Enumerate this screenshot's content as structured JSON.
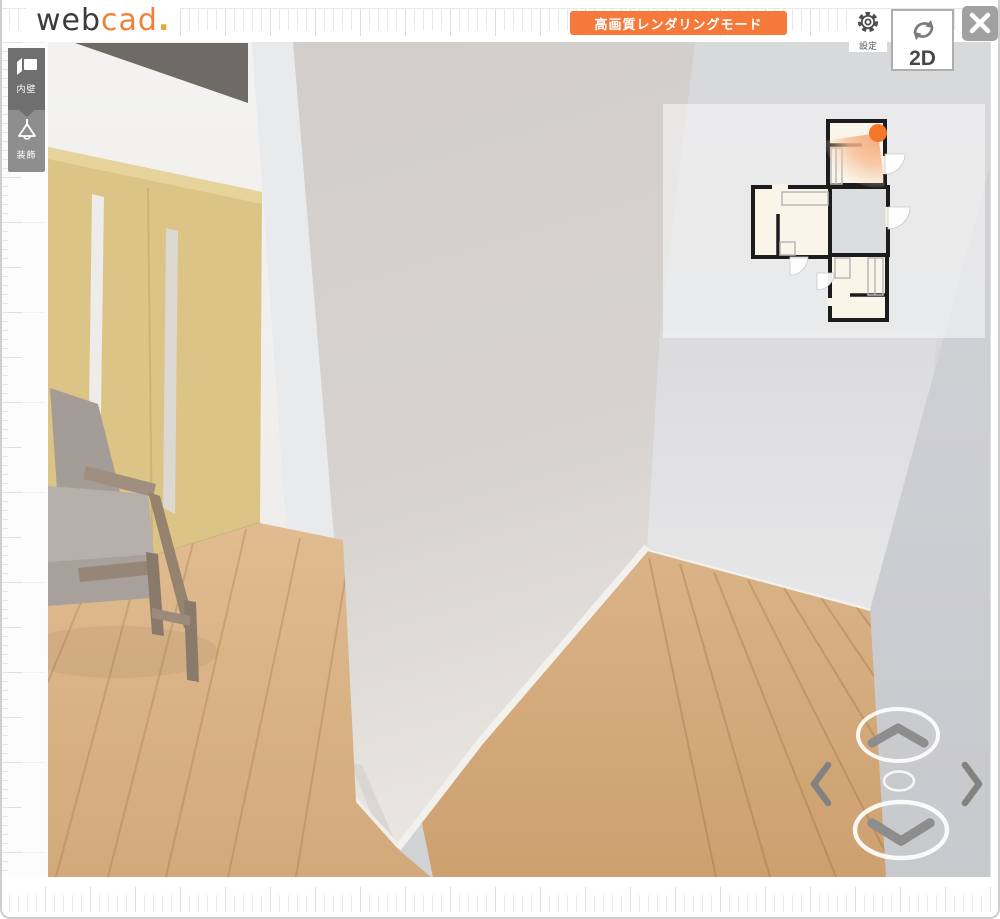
{
  "header": {
    "logo": {
      "part1": "web",
      "part2": "cad",
      "part3": "."
    },
    "render_mode_button": "高画質レンダリングモード",
    "settings": {
      "label": "設定"
    },
    "view_toggle": {
      "label": "2D"
    }
  },
  "toolbar": {
    "items": [
      {
        "id": "inner-wall",
        "label": "内壁",
        "active": true
      },
      {
        "id": "decoration",
        "label": "装飾",
        "active": false
      }
    ]
  },
  "colors": {
    "brand_orange": "#f0813a",
    "logo_dot_orange": "#eda43d",
    "button_orange": "#f4793b",
    "door_tan": "#dcc386",
    "ceiling_dark": "#6e6a66",
    "central_wall_gray": "#d5d2cf",
    "wood_floor": "#d4ab7d",
    "camera_marker": "#f4762b",
    "minimap_wall": "#1c1c1c",
    "minimap_room_fill": "#faf5e9",
    "nav_chevron_gray": "#8d8d8d"
  }
}
